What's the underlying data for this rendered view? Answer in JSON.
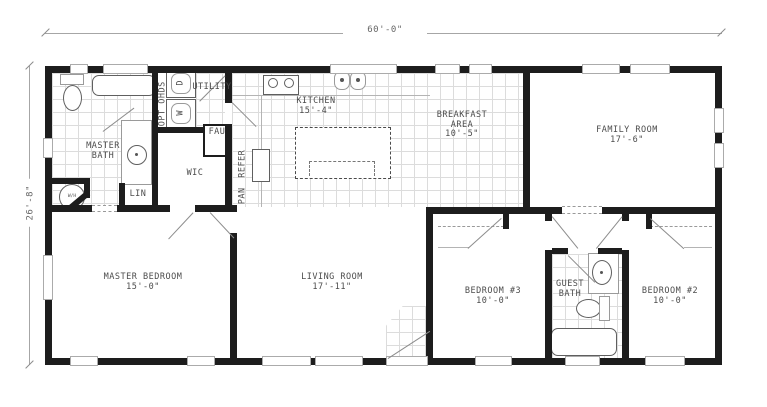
{
  "plan": {
    "dim_width": "60'-0\"",
    "dim_height": "26'-8\"",
    "rooms": {
      "master_bath": {
        "line1": "MASTER",
        "line2": "BATH"
      },
      "utility": {
        "label": "UTILITY"
      },
      "wic": {
        "label": "WIC"
      },
      "lin": {
        "label": "LIN"
      },
      "kitchen": {
        "name": "KITCHEN",
        "size": "15'-4\""
      },
      "breakfast": {
        "line1": "BREAKFAST",
        "line2": "AREA",
        "size": "10'-5\""
      },
      "family_room": {
        "name": "FAMILY ROOM",
        "size": "17'-6\""
      },
      "master_bedroom": {
        "name": "MASTER BEDROOM",
        "size": "15'-0\""
      },
      "living_room": {
        "name": "LIVING ROOM",
        "size": "17'-11\""
      },
      "bedroom3": {
        "name": "BEDROOM #3",
        "size": "10'-0\""
      },
      "guest_bath": {
        "line1": "GUEST",
        "line2": "BATH"
      },
      "bedroom2": {
        "name": "BEDROOM #2",
        "size": "10'-0\""
      }
    },
    "fixtures": {
      "opt_ohds": "OPT OHDS",
      "dryer": "D",
      "washer": "W",
      "fau": "FAU",
      "refrigerator": "REFER",
      "pantry": "PAN",
      "water_heater": "W/H"
    },
    "colors": {
      "wall": "#1d1d1d",
      "text": "#4c4c4c",
      "tile_grid": "#dcdcdc"
    }
  }
}
